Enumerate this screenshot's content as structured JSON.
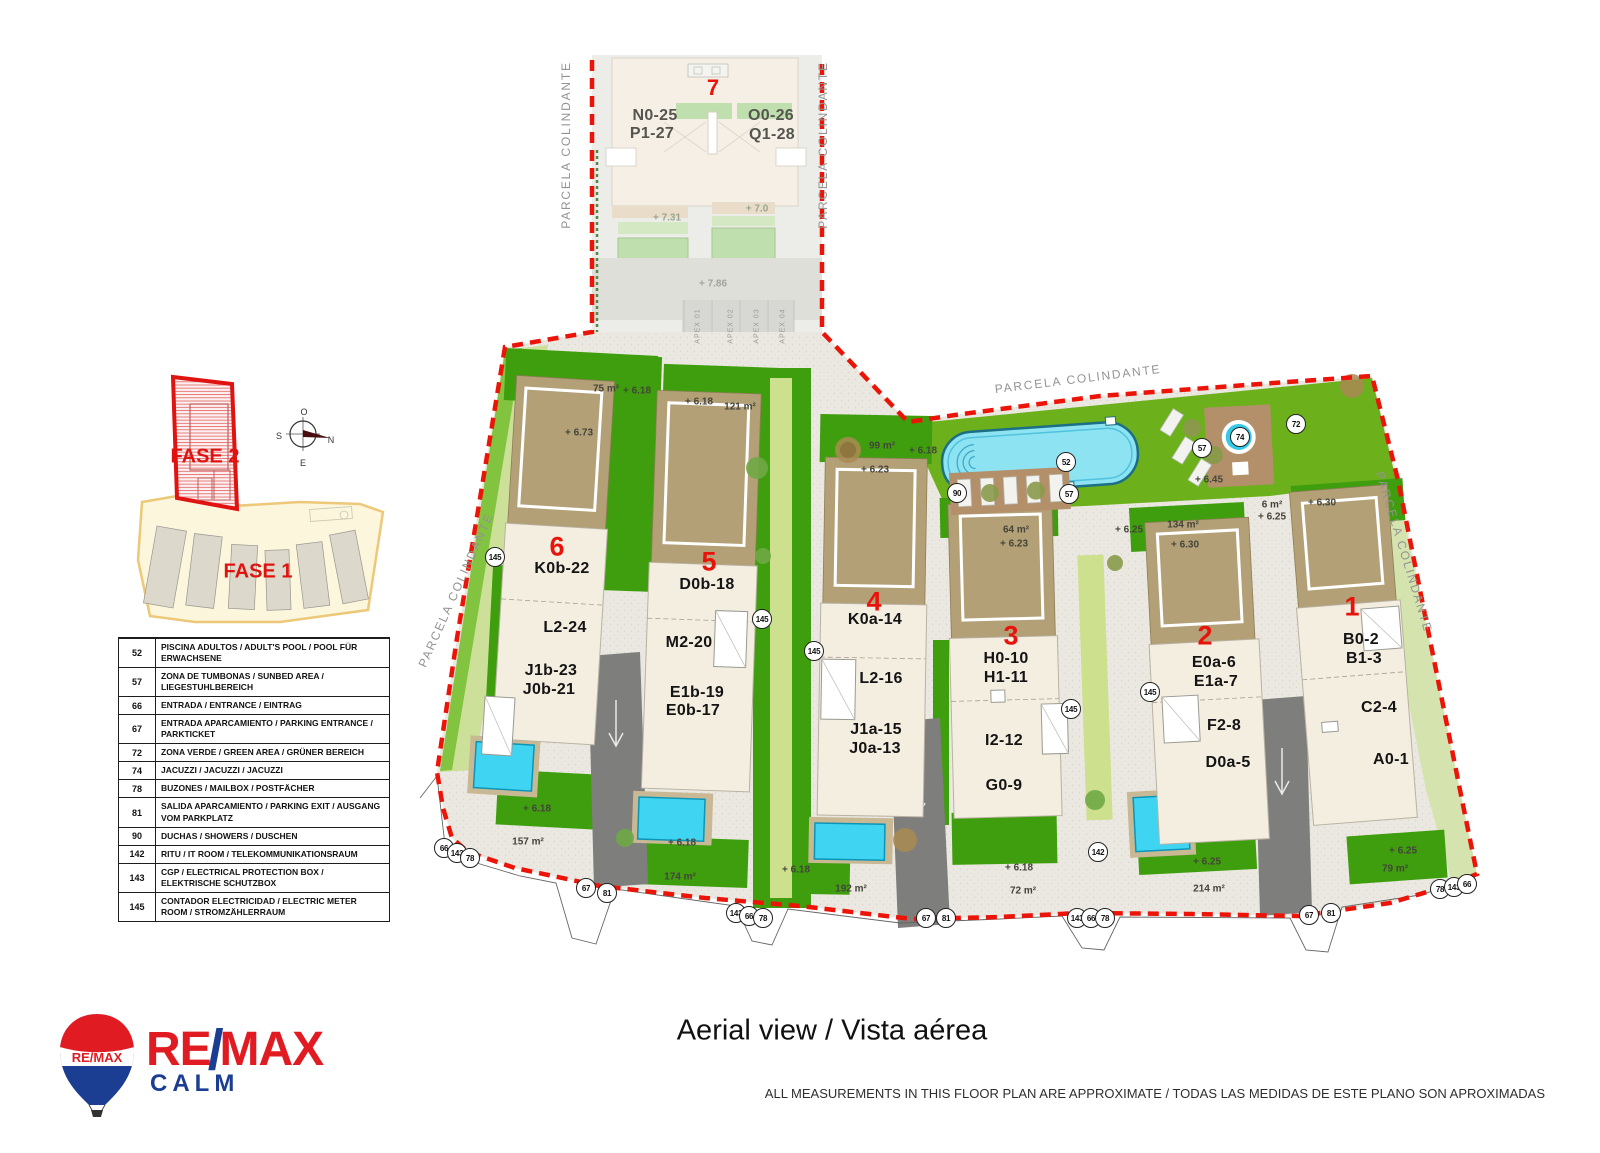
{
  "mini_map": {
    "fase2": "FASE 2",
    "fase1": "FASE 1"
  },
  "compass": {
    "o": "O",
    "n": "N",
    "s": "S",
    "e": "E"
  },
  "legend": {
    "rows": [
      {
        "num": "52",
        "text": "PISCINA ADULTOS  / ADULT'S POOL / POOL FÜR ERWACHSENE"
      },
      {
        "num": "57",
        "text": "ZONA DE TUMBONAS  / SUNBED AREA / LIEGESTUHLBEREICH"
      },
      {
        "num": "66",
        "text": "ENTRADA / ENTRANCE / EINTRAG"
      },
      {
        "num": "67",
        "text": "ENTRADA APARCAMIENTO / PARKING ENTRANCE / PARKTICKET"
      },
      {
        "num": "72",
        "text": "ZONA VERDE / GREEN AREA / GRÜNER BEREICH"
      },
      {
        "num": "74",
        "text": "JACUZZI / JACUZZI / JACUZZI"
      },
      {
        "num": "78",
        "text": "BUZONES / MAILBOX / POSTFÄCHER"
      },
      {
        "num": "81",
        "text": "SALIDA APARCAMIENTO / PARKING EXIT / AUSGANG VOM PARKPLATZ"
      },
      {
        "num": "90",
        "text": "DUCHAS / SHOWERS / DUSCHEN"
      },
      {
        "num": "142",
        "text": "RITU / IT ROOM / TELEKOMMUNIKATIONSRAUM"
      },
      {
        "num": "143",
        "text": "CGP / ELECTRICAL PROTECTION BOX / ELEKTRISCHE SCHUTZBOX"
      },
      {
        "num": "145",
        "text": "CONTADOR ELECTRICIDAD / ELECTRIC METER ROOM / STROMZÄHLERRAUM"
      }
    ]
  },
  "plan": {
    "building_numbers": [
      {
        "text": "7",
        "x": 713,
        "y": 88,
        "size": 22
      },
      {
        "text": "6",
        "x": 557,
        "y": 547
      },
      {
        "text": "5",
        "x": 709,
        "y": 562
      },
      {
        "text": "4",
        "x": 874,
        "y": 602
      },
      {
        "text": "3",
        "x": 1011,
        "y": 636
      },
      {
        "text": "2",
        "x": 1205,
        "y": 636
      },
      {
        "text": "1",
        "x": 1352,
        "y": 607
      }
    ],
    "unit_labels": [
      {
        "text": "N0-25",
        "x": 655,
        "y": 116,
        "color": "#555550"
      },
      {
        "text": "O0-26",
        "x": 771,
        "y": 116,
        "color": "#555550"
      },
      {
        "text": "P1-27",
        "x": 652,
        "y": 134,
        "color": "#555550"
      },
      {
        "text": "Q1-28",
        "x": 772,
        "y": 135,
        "color": "#555550"
      },
      {
        "text": "K0b-22",
        "x": 562,
        "y": 569
      },
      {
        "text": "L2-24",
        "x": 565,
        "y": 628
      },
      {
        "text": "J1b-23",
        "x": 551,
        "y": 671
      },
      {
        "text": "J0b-21",
        "x": 549,
        "y": 690
      },
      {
        "text": "D0b-18",
        "x": 707,
        "y": 585
      },
      {
        "text": "M2-20",
        "x": 689,
        "y": 643
      },
      {
        "text": "E1b-19",
        "x": 697,
        "y": 693
      },
      {
        "text": "E0b-17",
        "x": 693,
        "y": 711
      },
      {
        "text": "K0a-14",
        "x": 875,
        "y": 620
      },
      {
        "text": "L2-16",
        "x": 881,
        "y": 679
      },
      {
        "text": "J1a-15",
        "x": 876,
        "y": 730
      },
      {
        "text": "J0a-13",
        "x": 875,
        "y": 749
      },
      {
        "text": "H0-10",
        "x": 1006,
        "y": 659
      },
      {
        "text": "H1-11",
        "x": 1006,
        "y": 678
      },
      {
        "text": "I2-12",
        "x": 1004,
        "y": 741
      },
      {
        "text": "G0-9",
        "x": 1004,
        "y": 786
      },
      {
        "text": "E0a-6",
        "x": 1214,
        "y": 663
      },
      {
        "text": "E1a-7",
        "x": 1216,
        "y": 682
      },
      {
        "text": "F2-8",
        "x": 1224,
        "y": 726
      },
      {
        "text": "D0a-5",
        "x": 1228,
        "y": 763
      },
      {
        "text": "B0-2",
        "x": 1361,
        "y": 640
      },
      {
        "text": "B1-3",
        "x": 1364,
        "y": 659
      },
      {
        "text": "C2-4",
        "x": 1379,
        "y": 708
      },
      {
        "text": "A0-1",
        "x": 1391,
        "y": 760
      }
    ],
    "area_labels": [
      {
        "text": "75 m²",
        "x": 606,
        "y": 389
      },
      {
        "text": "+ 6.18",
        "x": 637,
        "y": 391
      },
      {
        "text": "+ 6.18",
        "x": 699,
        "y": 402
      },
      {
        "text": "121 m²",
        "x": 740,
        "y": 407
      },
      {
        "text": "+ 6.73",
        "x": 579,
        "y": 433
      },
      {
        "text": "99 m²",
        "x": 882,
        "y": 446
      },
      {
        "text": "+ 6.18",
        "x": 923,
        "y": 451
      },
      {
        "text": "+ 6.23",
        "x": 875,
        "y": 470
      },
      {
        "text": "64 m²",
        "x": 1016,
        "y": 530
      },
      {
        "text": "+ 6.23",
        "x": 1014,
        "y": 544
      },
      {
        "text": "+ 6.25",
        "x": 1129,
        "y": 530
      },
      {
        "text": "134 m²",
        "x": 1183,
        "y": 525
      },
      {
        "text": "+ 6.30",
        "x": 1185,
        "y": 545
      },
      {
        "text": "6 m²",
        "x": 1272,
        "y": 505
      },
      {
        "text": "+ 6.25",
        "x": 1272,
        "y": 517
      },
      {
        "text": "+ 6.30",
        "x": 1322,
        "y": 503
      },
      {
        "text": "+ 6.45",
        "x": 1209,
        "y": 480
      },
      {
        "text": "157 m²",
        "x": 528,
        "y": 842
      },
      {
        "text": "+ 6.18",
        "x": 537,
        "y": 809
      },
      {
        "text": "+ 6.18",
        "x": 682,
        "y": 843
      },
      {
        "text": "174 m²",
        "x": 680,
        "y": 877
      },
      {
        "text": "+ 6.18",
        "x": 796,
        "y": 870
      },
      {
        "text": "192 m²",
        "x": 851,
        "y": 889
      },
      {
        "text": "+ 6.18",
        "x": 1019,
        "y": 868
      },
      {
        "text": "72 m²",
        "x": 1023,
        "y": 891
      },
      {
        "text": "+ 6.25",
        "x": 1207,
        "y": 862
      },
      {
        "text": "214 m²",
        "x": 1209,
        "y": 889
      },
      {
        "text": "+ 6.25",
        "x": 1403,
        "y": 851
      },
      {
        "text": "79 m²",
        "x": 1395,
        "y": 869
      },
      {
        "text": "+ 7.31",
        "x": 667,
        "y": 218,
        "color": "#9aa58e"
      },
      {
        "text": "+ 7.0",
        "x": 757,
        "y": 209,
        "color": "#9aa58e"
      },
      {
        "text": "+ 7.86",
        "x": 713,
        "y": 284,
        "color": "#a3a39c"
      }
    ],
    "callouts": [
      {
        "num": "52",
        "x": 1066,
        "y": 462
      },
      {
        "num": "57",
        "x": 1202,
        "y": 448
      },
      {
        "num": "57",
        "x": 1069,
        "y": 494
      },
      {
        "num": "74",
        "x": 1240,
        "y": 437
      },
      {
        "num": "72",
        "x": 1296,
        "y": 424
      },
      {
        "num": "90",
        "x": 957,
        "y": 493
      },
      {
        "num": "145",
        "x": 495,
        "y": 557
      },
      {
        "num": "145",
        "x": 762,
        "y": 619
      },
      {
        "num": "145",
        "x": 814,
        "y": 651
      },
      {
        "num": "145",
        "x": 1071,
        "y": 709
      },
      {
        "num": "145",
        "x": 1150,
        "y": 692
      },
      {
        "num": "66",
        "x": 444,
        "y": 848
      },
      {
        "num": "143",
        "x": 457,
        "y": 853
      },
      {
        "num": "78",
        "x": 470,
        "y": 858
      },
      {
        "num": "67",
        "x": 586,
        "y": 888
      },
      {
        "num": "81",
        "x": 607,
        "y": 893
      },
      {
        "num": "143",
        "x": 736,
        "y": 913
      },
      {
        "num": "66",
        "x": 749,
        "y": 916
      },
      {
        "num": "78",
        "x": 763,
        "y": 918
      },
      {
        "num": "67",
        "x": 926,
        "y": 918
      },
      {
        "num": "81",
        "x": 946,
        "y": 918
      },
      {
        "num": "143",
        "x": 1077,
        "y": 918
      },
      {
        "num": "66",
        "x": 1091,
        "y": 918
      },
      {
        "num": "78",
        "x": 1105,
        "y": 918
      },
      {
        "num": "142",
        "x": 1098,
        "y": 852
      },
      {
        "num": "67",
        "x": 1309,
        "y": 915
      },
      {
        "num": "81",
        "x": 1331,
        "y": 913
      },
      {
        "num": "78",
        "x": 1440,
        "y": 889
      },
      {
        "num": "143",
        "x": 1454,
        "y": 887
      },
      {
        "num": "66",
        "x": 1467,
        "y": 884
      }
    ],
    "parcela_labels": [
      {
        "text": "PARCELA COLINDANTE",
        "x": 566,
        "y": 145,
        "rot": -90
      },
      {
        "text": "PARCELA COLINDANTE",
        "x": 823,
        "y": 145,
        "rot": -90
      },
      {
        "text": "PARCELA COLINDANTE",
        "x": 1078,
        "y": 379,
        "rot": -7
      },
      {
        "text": "PARCELA COLINDANTE",
        "x": 1404,
        "y": 552,
        "rot": 73
      },
      {
        "text": "PARCELA COLINDANTE",
        "x": 456,
        "y": 590,
        "rot": -66
      }
    ],
    "apex_labels": [
      {
        "text": "APEX 01",
        "x": 698,
        "y": 326,
        "rot": -90
      },
      {
        "text": "APEX 02",
        "x": 731,
        "y": 326,
        "rot": -90
      },
      {
        "text": "APEX 03",
        "x": 757,
        "y": 326,
        "rot": -90
      },
      {
        "text": "APEX 04",
        "x": 783,
        "y": 326,
        "rot": -90
      }
    ]
  },
  "footer": {
    "title": "Aerial view / Vista aérea",
    "disclaimer": "ALL MEASUREMENTS IN THIS FLOOR PLAN ARE APPROXIMATE / TODAS LAS MEDIDAS DE ESTE PLANO SON APROXIMADAS"
  },
  "logo": {
    "re": "RE",
    "slash": "/",
    "max": "MAX",
    "sub": "CALM",
    "balloon_text": "RE/MAX"
  }
}
